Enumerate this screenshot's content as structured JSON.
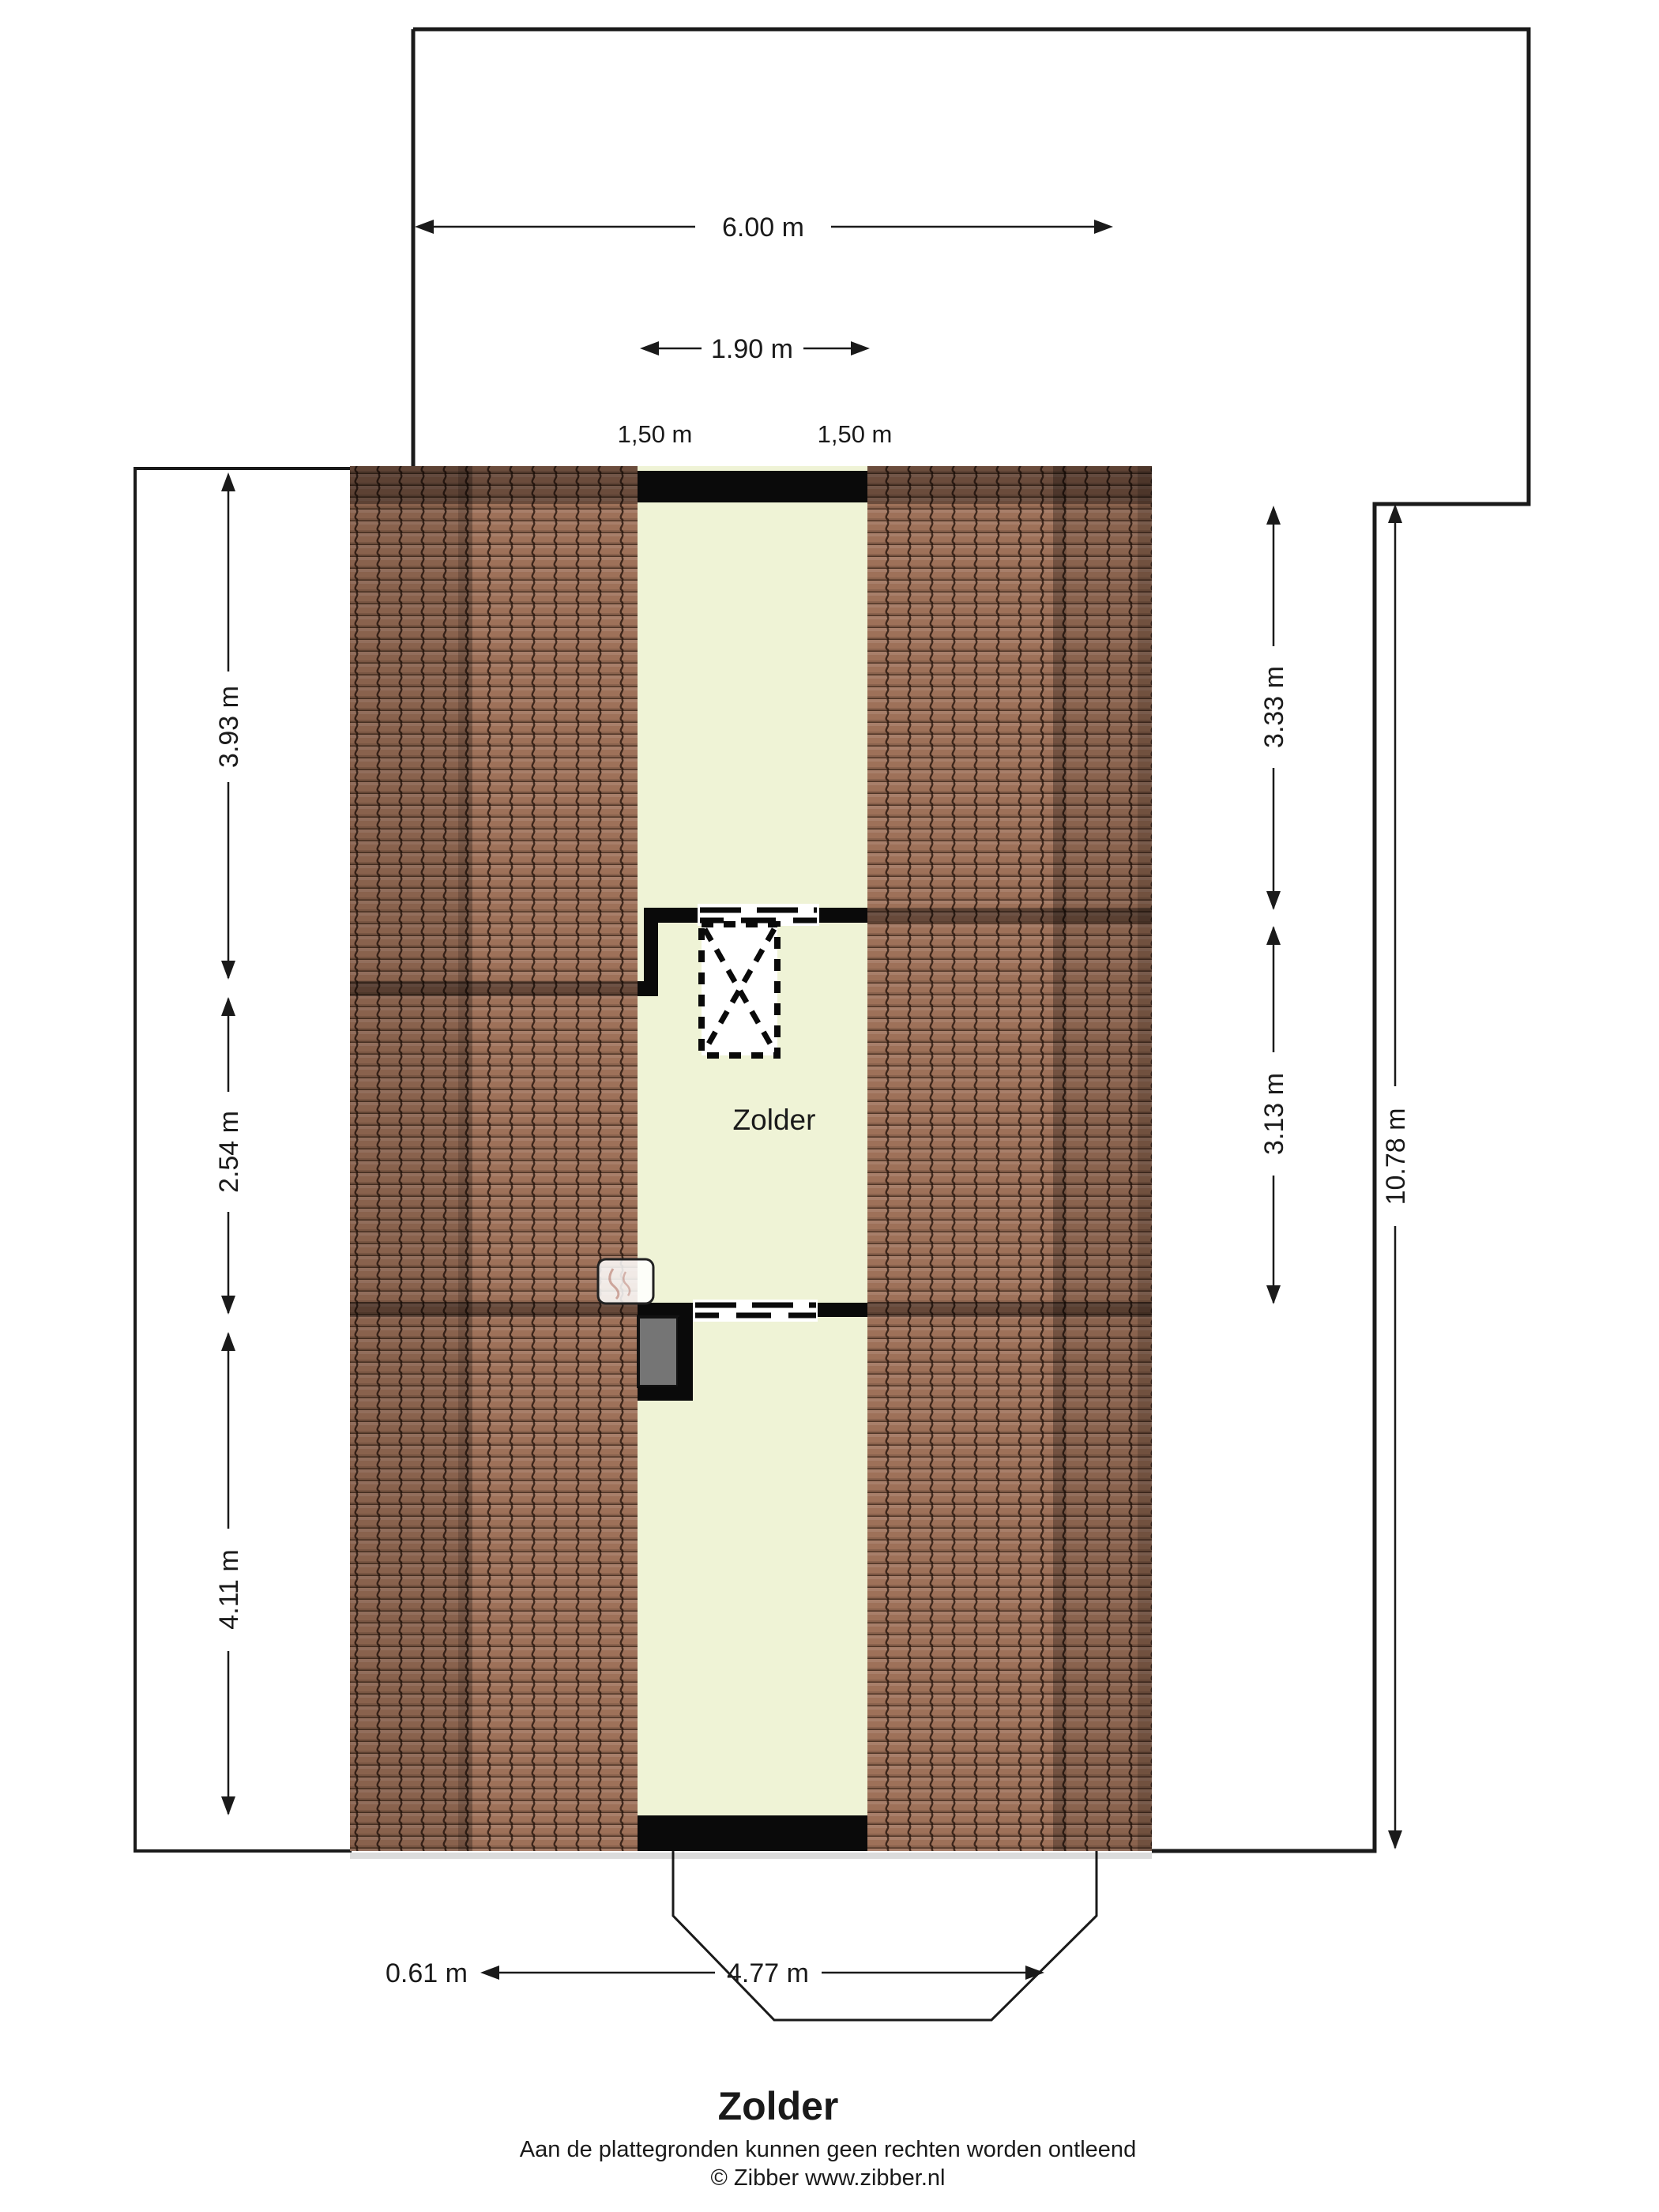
{
  "page_title": "Zolder",
  "floor": {
    "room_label": "Zolder"
  },
  "dimensions": {
    "top_width": "6.00 m",
    "inner_width": "1.90 m",
    "top_left_sub": "1,50 m",
    "top_right_sub": "1,50 m",
    "left_top": "3.93 m",
    "left_mid": "2.54 m",
    "left_bottom": "4.11 m",
    "right_top": "3.33 m",
    "right_mid": "3.13 m",
    "right_total": "10.78 m",
    "bottom_small": "0.61 m",
    "bottom_main": "4.77 m"
  },
  "footer": {
    "title": "Zolder",
    "disclaimer": "Aan de plattegronden kunnen geen rechten worden ontleend",
    "copyright": "© Zibber www.zibber.nl"
  },
  "colors": {
    "room_fill": "#eff3d6",
    "roof_tile": "#9c7157",
    "wall": "#0a0a0a",
    "box_gray": "#757575",
    "line": "#1a1a1a"
  }
}
